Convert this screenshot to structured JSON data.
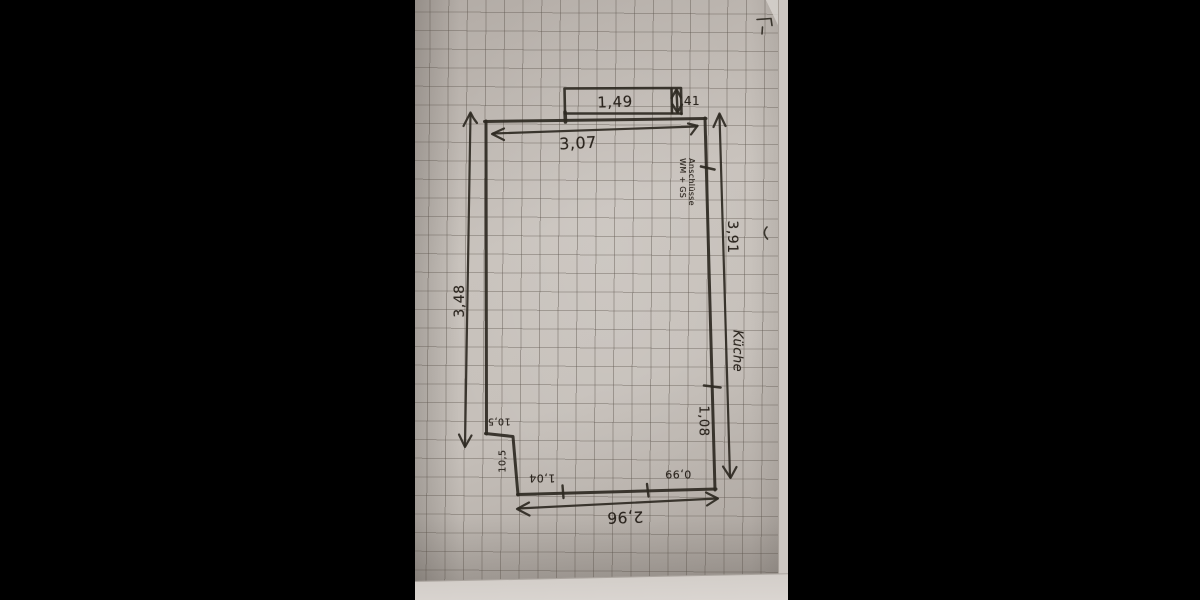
{
  "photo": {
    "description": "Hand-drawn floor plan sketch of a kitchen on squared graph paper",
    "room_label": "Küche",
    "connection_note": {
      "line1": "Anschlüsse",
      "line2": "WM + GS"
    },
    "dimensions": {
      "top_wall": "3,07",
      "window_width": "1,49",
      "window_depth": "41",
      "right_wall_upper": "3,91",
      "right_wall_lower": "1,08",
      "left_wall": "3,48",
      "step_width": "10,5",
      "step_depth": "10,5",
      "bottom_segment_left": "1,04",
      "bottom_segment_right": "0,99",
      "bottom_wall_total": "2,96"
    },
    "colors": {
      "letterbox": "#000000",
      "paper": "#c6c0ba",
      "grid_line": "#8d857d",
      "ink": "#2b2620"
    }
  }
}
